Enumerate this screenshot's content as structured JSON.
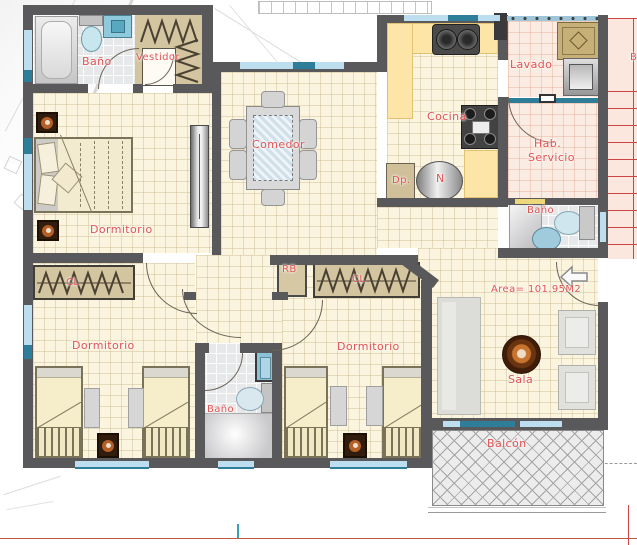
{
  "labels": {
    "bano_tl": "Baño",
    "vestidor": "Vestidor",
    "dormitorio_master": "Dormitorio",
    "comedor": "Comedor",
    "cocina": "Cocina",
    "lavado": "Lavado",
    "hab": "Hab.",
    "servicio": "Servicio",
    "dp": "Dp.",
    "n": "N",
    "bano_servicio": "Baño",
    "area": "Area= 101.95M2",
    "sala": "Sala",
    "balcon": "Balcón",
    "cl_left": "CL",
    "cl_center": "CL",
    "rb": "RB",
    "dormitorio_bl": "Dormitorio",
    "dormitorio_bc": "Dormitorio",
    "bano_bottom": "Baño",
    "stair_b": "B"
  },
  "colors": {
    "wall": "#59595b",
    "label": "#e25353",
    "window_dark": "#2e7d99",
    "window_light": "#bcdeee",
    "floor": "#fbf4df",
    "counter": "#fce5a6",
    "closet": "#d3c5a0",
    "stair_line": "#cc4444"
  }
}
